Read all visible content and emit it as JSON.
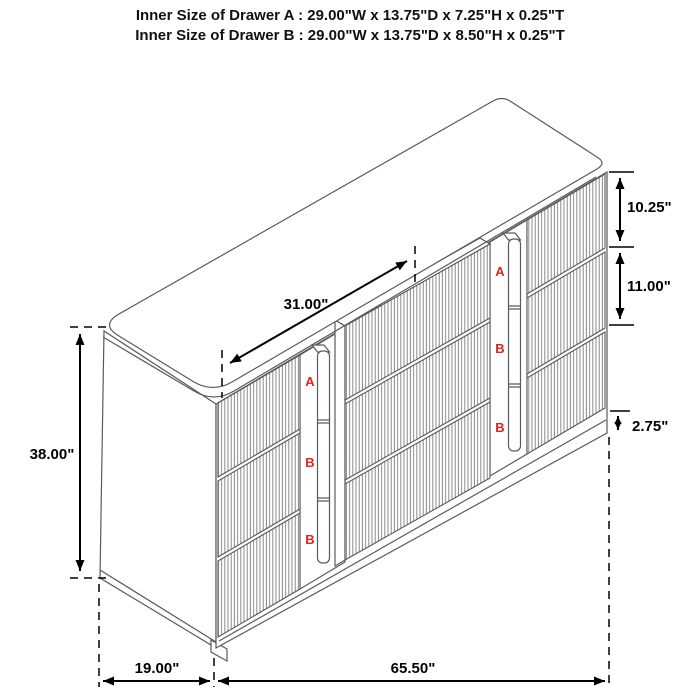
{
  "title": {
    "line1": "Inner Size of Drawer A : 29.00\"W x 13.75\"D x 7.25\"H x 0.25\"T",
    "line2": "Inner Size of Drawer B : 29.00\"W x 13.75\"D x 8.50\"H x 0.25\"T"
  },
  "dimensions": {
    "diagonal_top": "31.00\"",
    "overall_height": "38.00\"",
    "top_drawer_height": "10.25\"",
    "middle_drawer_height": "11.00\"",
    "base_height": "2.75\"",
    "side_depth": "19.00\"",
    "front_width": "65.50\""
  },
  "drawer_labels": {
    "middle_stack": [
      "A",
      "B",
      "B"
    ],
    "right_stack": [
      "A",
      "B",
      "B"
    ]
  },
  "colors": {
    "furniture_line": "#5a5a5a",
    "flute_line": "#7d7d7d",
    "dimension_line": "#000000",
    "label_red": "#e02420",
    "background": "#ffffff"
  }
}
